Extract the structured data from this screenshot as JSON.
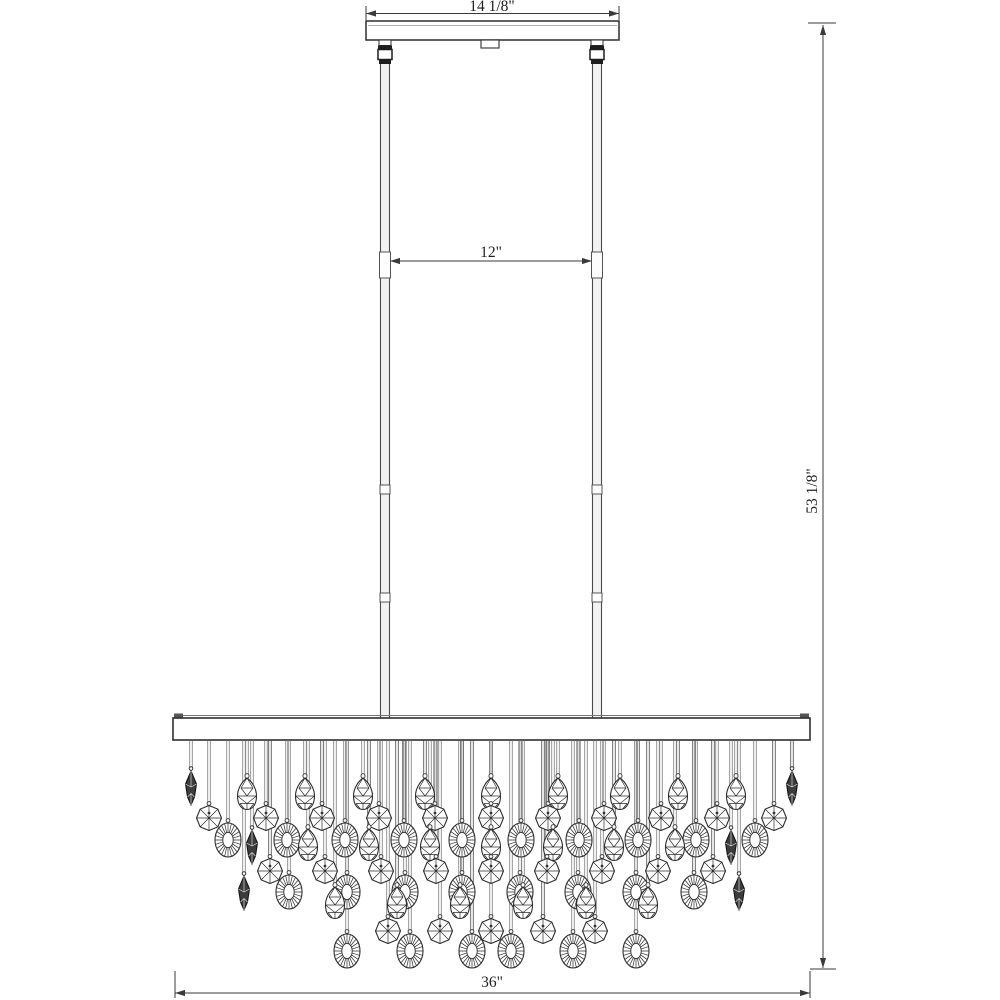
{
  "document": {
    "type": "chandelier-dimension-line-drawing",
    "background": "#ffffff"
  },
  "dimensions": {
    "canopy_width": "14 1/8\"",
    "rod_spacing": "12\"",
    "overall_height": "53 1/8\"",
    "fixture_width": "36\""
  },
  "colors": {
    "line": "#2e2e2e",
    "dim_line": "#3a3a3a",
    "wire": "#8a8a8a",
    "wire_dark": "#5a5a5a",
    "prism_fill": "#3c3c3c",
    "rod_fill": "#f2f2f2",
    "hardware_dark": "#1e1e1e"
  },
  "diagram": {
    "frame_bottom_y": 740,
    "crystal_rows": [
      {
        "type": "teardrop",
        "y": 794,
        "xs": [
          247,
          305,
          363,
          425,
          491,
          558,
          620,
          678,
          736
        ]
      },
      {
        "type": "octagon",
        "y": 818,
        "xs": [
          209,
          266,
          322,
          379,
          435,
          491,
          548,
          604,
          661,
          717,
          774
        ]
      },
      {
        "type": "oval",
        "y": 840,
        "xs": [
          228,
          287,
          345,
          404,
          462,
          521,
          579,
          638,
          696,
          755
        ]
      },
      {
        "type": "teardrop",
        "y": 845,
        "xs": [
          308,
          369,
          430,
          491,
          553,
          614,
          675
        ]
      },
      {
        "type": "octagon",
        "y": 871,
        "xs": [
          270,
          325,
          381,
          436,
          491,
          547,
          602,
          658,
          713
        ]
      },
      {
        "type": "oval",
        "y": 892,
        "xs": [
          289,
          347,
          405,
          462,
          520,
          578,
          636,
          694
        ]
      },
      {
        "type": "teardrop",
        "y": 903,
        "xs": [
          335,
          397,
          460,
          523,
          586,
          648
        ]
      },
      {
        "type": "octagon",
        "y": 931,
        "xs": [
          388,
          440,
          491,
          543,
          595
        ]
      },
      {
        "type": "oval",
        "y": 951,
        "xs": [
          347,
          410,
          472,
          511,
          573,
          636
        ]
      }
    ],
    "prisms": [
      [
        191,
        788
      ],
      [
        792,
        788
      ],
      [
        252,
        847
      ],
      [
        731,
        847
      ],
      [
        244,
        893
      ],
      [
        739,
        893
      ]
    ]
  }
}
